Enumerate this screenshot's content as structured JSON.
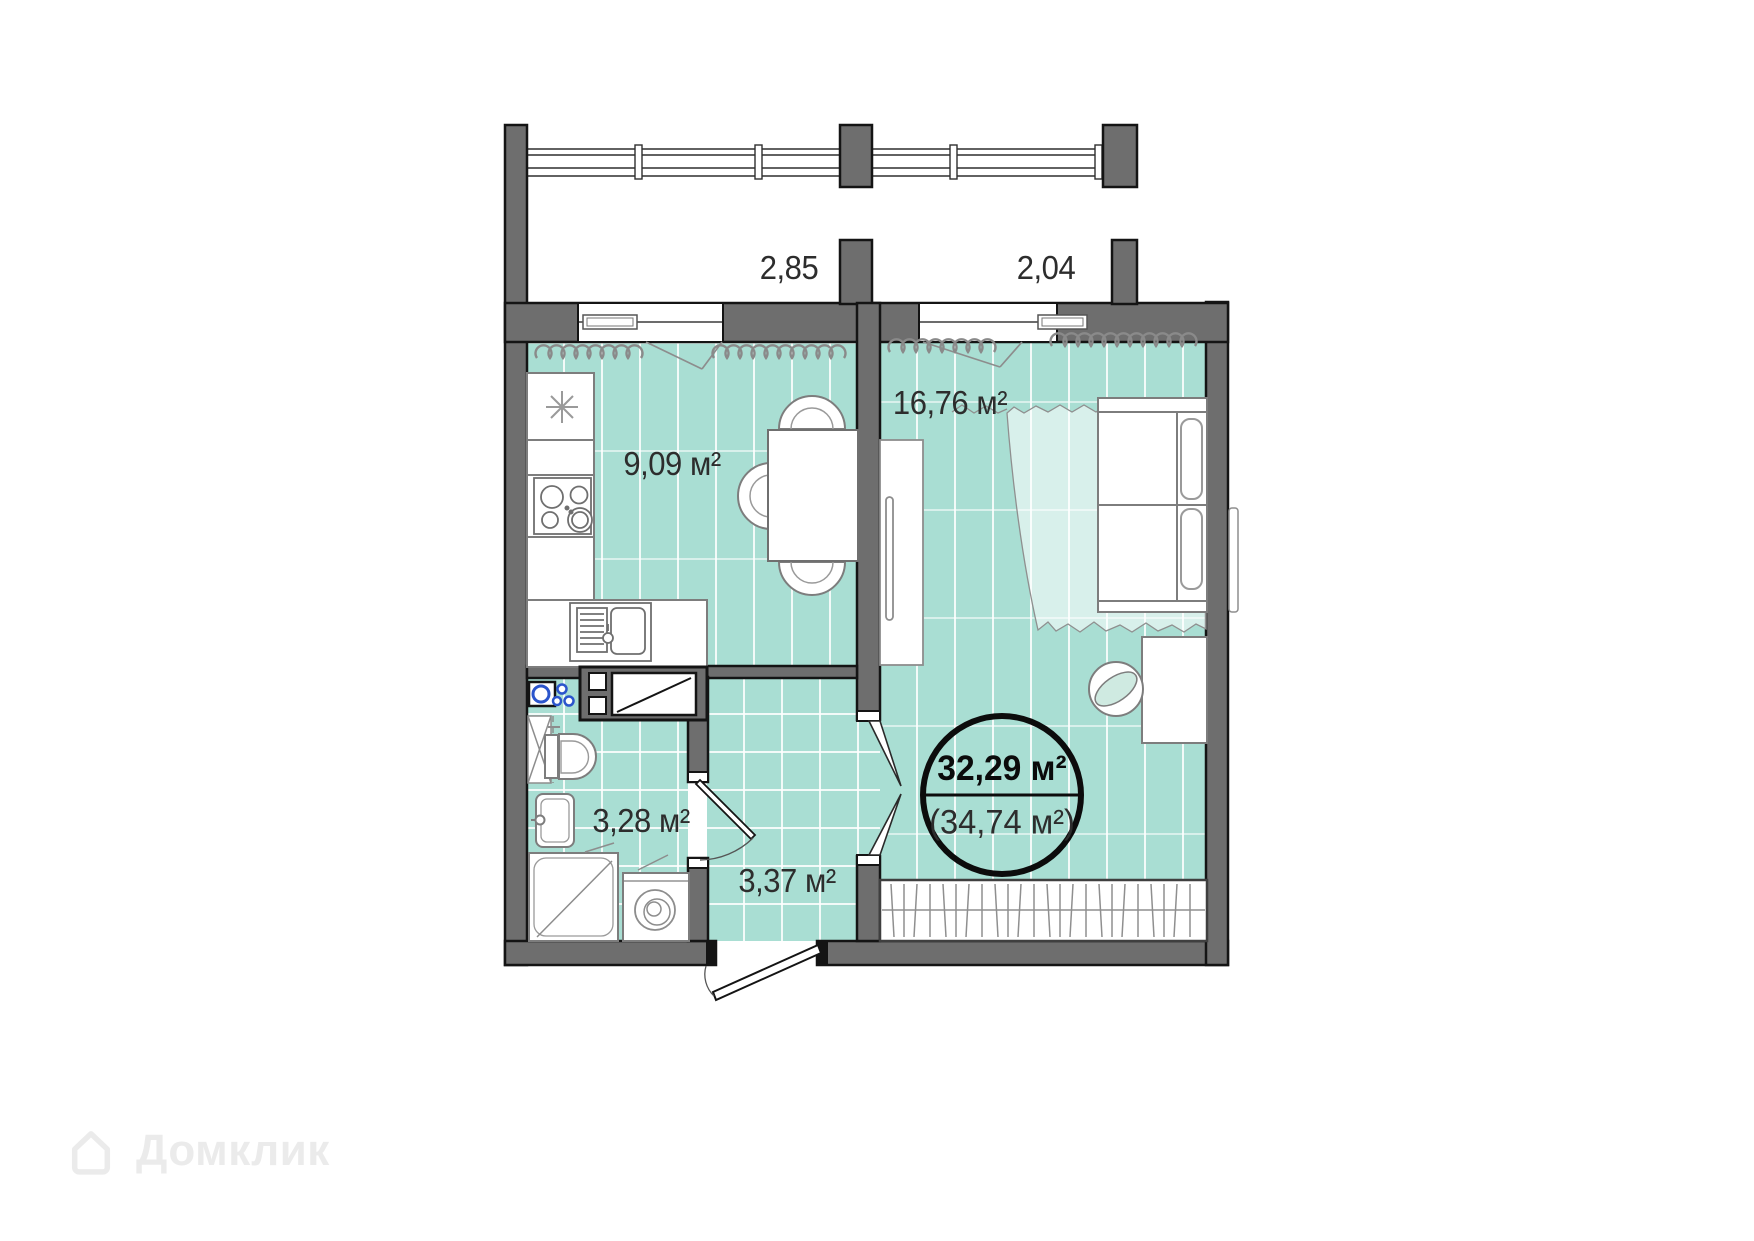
{
  "colors": {
    "wall_fill": "#6e6e6e",
    "wall_outline": "#141414",
    "floor_teal": "#a9ded3",
    "curtain_overlay": "rgba(255,255,255,0.55)",
    "plumbing_blue": "#2b55cc",
    "label_text": "#2d2d2d"
  },
  "plan": {
    "balconies": {
      "left_width_label": "2,85",
      "right_width_label": "2,04"
    },
    "rooms": {
      "kitchen_area": "9,09 м²",
      "living_area": "16,76 м²",
      "bathroom_area": "3,28 м²",
      "hallway_area": "3,37 м²"
    },
    "total": {
      "main_area": "32,29 м²",
      "area_with_balcony": "(34,74 м²)"
    }
  },
  "watermark": {
    "brand": "Домклик"
  }
}
